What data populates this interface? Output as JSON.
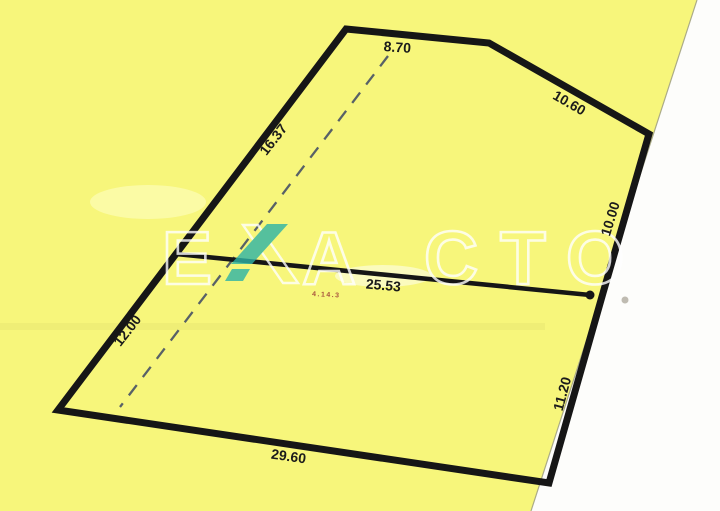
{
  "plan": {
    "dimensions": {
      "top_edge": "8.70",
      "upper_right_edge": "10.60",
      "right_edge": "10.00",
      "lower_right_edge": "11.20",
      "bottom_edge": "29.60",
      "lower_left_edge": "12.00",
      "upper_left_edge": "16.37",
      "middle_line": "25.53"
    },
    "red_note": "4.14.3"
  },
  "watermark": {
    "word": "EXACTO",
    "letters": [
      "E",
      "X",
      "A",
      "C",
      "T",
      "O"
    ]
  },
  "colors": {
    "paper_yellow": "#f7f67b",
    "paper_highlight": "#ffffc9",
    "parcel_line_black": "#161616",
    "dashed_line_blue_gray": "#4b5566",
    "watermark_teal": "#2db3a6",
    "watermark_outline_white": "#ffffff",
    "off_plan_white": "#fdfdfb",
    "off_plan_edge": "#a3a382",
    "red_note": "#9b3a34"
  }
}
